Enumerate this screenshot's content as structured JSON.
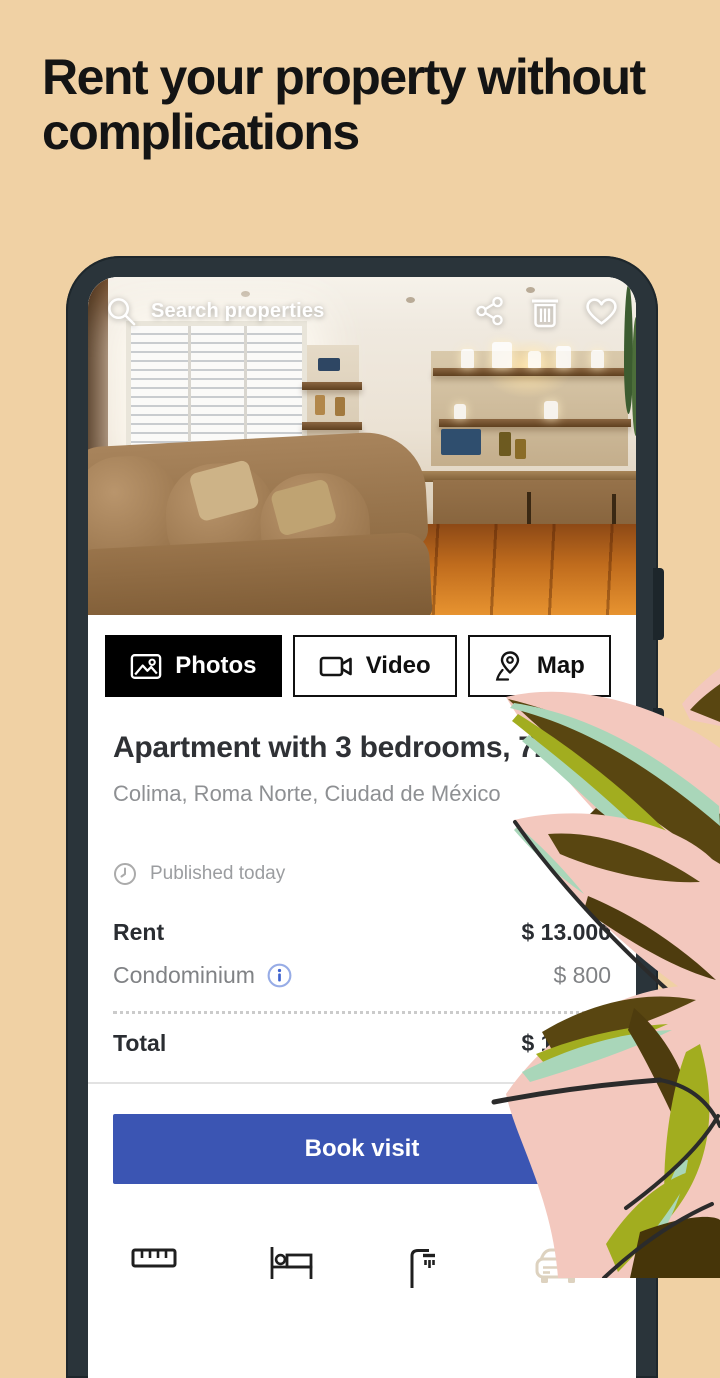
{
  "page": {
    "background_color": "#f0d1a4",
    "headline": "Rent your property without complications"
  },
  "phone": {
    "search_bar": {
      "placeholder": "Search properties",
      "action_icons": [
        "search-icon",
        "share-icon",
        "trash-icon",
        "heart-icon"
      ]
    },
    "media_tabs": [
      {
        "label": "Photos",
        "icon": "photos-icon",
        "active": true
      },
      {
        "label": "Video",
        "icon": "video-icon",
        "active": false
      },
      {
        "label": "Map",
        "icon": "map-pin-icon",
        "active": false
      }
    ],
    "listing": {
      "title": "Apartment with 3 bedrooms, 72m²",
      "location": "Colima, Roma Norte, Ciudad de México",
      "published": "Published today",
      "price_rows": [
        {
          "label": "Rent",
          "value": "$ 13.000"
        },
        {
          "label": "Condominium",
          "value": "$ 800"
        }
      ],
      "total_label": "Total",
      "total_value": "$ 13.800",
      "cta_label": "Book visit",
      "amenity_icons": [
        "ruler-icon",
        "bed-icon",
        "shower-icon",
        "car-icon"
      ]
    },
    "colors": {
      "cta_blue": "#3b55b3",
      "tab_active_bg": "#000000",
      "info_blue": "#3f63cf",
      "phone_frame": "#2a343a",
      "leaf_pink": "#f3c8be",
      "leaf_olive": "#594611",
      "leaf_green": "#a2ad1f",
      "leaf_mint": "#a9d6b9"
    }
  }
}
